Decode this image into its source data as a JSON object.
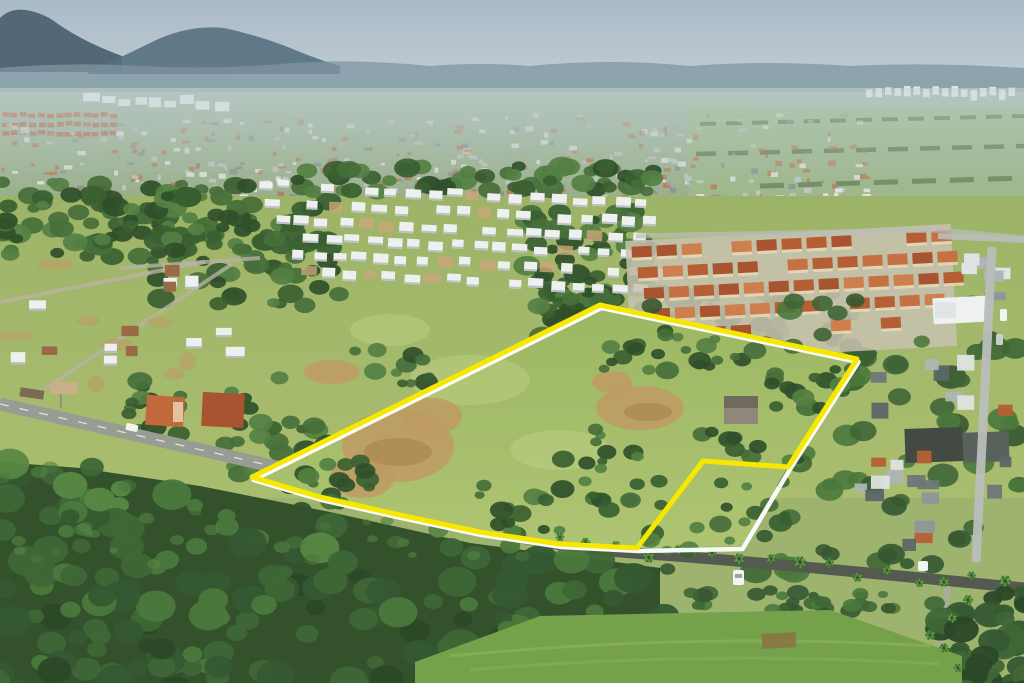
{
  "scene": {
    "description": "Aerial drone photograph of a suburban neighborhood; a vacant grassy land parcel in the foreground is outlined with a bright yellow boundary line, with a small corner sub-lot delimited in white; dense forest in the foreground, housing developments and distant city with hazy mountains behind",
    "seed": 7,
    "features": [
      "sky",
      "mountains",
      "distant-city",
      "housing-development",
      "townhouse-complex",
      "vacant-parcel",
      "boundary-overlay",
      "forest",
      "roads",
      "palm-trees",
      "cars"
    ]
  },
  "overlay": {
    "site_points": "252,477 600,305 857,359 788,467 741,546 637,548 560,544 480,532 400,515 320,497",
    "parcel_points": "252,477 600,305 857,359 788,467 703,461 637,548 560,544 480,532 400,515 320,497",
    "site_color": "#ffffff",
    "parcel_color": "#f7e800",
    "site_width": "4.5",
    "parcel_width": "5"
  },
  "palette": {
    "sky_top": "#a9bac8",
    "sky_bottom": "#c7d0d5",
    "mountain_near": "#4d6371",
    "mountain_mid": "#567080",
    "hills_far": "#7e96a3",
    "hills_faint": "#8ba4a4",
    "valley_top": "#a2b59f",
    "valley_bottom": "#93ab7e",
    "haze": "#c5d4dc",
    "city_white": "#e9ebe8",
    "city_gray": "#c2c7c5",
    "city_terra": "#b96f4a",
    "city_slate": "#98a2a6",
    "city_dark": "#7e8a8e",
    "terra_row": "#b66a45",
    "dev_white": "#edf0ef",
    "dev_shadow": "#b5bcbf",
    "dev_dirt": "#c9a878",
    "grove_greens": [
      "#2f4f2a",
      "#3a5f31",
      "#476f39",
      "#548043"
    ],
    "field_mid": "#a0b76b",
    "field_light": "#aabe70",
    "meadow": "#a4bd68",
    "meadow_light": "#bdd083",
    "dirt": "#c09a64",
    "dirt_dark": "#a9834f",
    "roof_terracotta": [
      "#b65f35",
      "#c57143",
      "#a85430",
      "#cd7f4e"
    ],
    "wall_cream": "#ead9b6",
    "complex_ground": "#c8c2b0",
    "shed_wall": "#8d8879",
    "shed_roof": "#6e6a5e",
    "gray_roofs": [
      "#8e9799",
      "#6d7779",
      "#aeb5b6",
      "#dfe3e3",
      "#5c6668"
    ],
    "warehouse_dark": "#434a42",
    "warehouse_mid": "#59625a",
    "road_light": "#989d94",
    "road_dash": "#e9e9e2",
    "road_dark": "#545a4f",
    "street_concrete": "#b9beba",
    "path_light": "#a9ae9e",
    "forest_greens": [
      "#2b4827",
      "#355831",
      "#3f6636",
      "#4b783c",
      "#588745"
    ],
    "forest_base": "#33522b",
    "palm_leaf": "#5f9e44",
    "palm_dark": "#3c6a2f",
    "grass_field": "#76a14b",
    "grass_stripe": "#8fb75e",
    "car_white": "#f2f4f2",
    "car_silver": "#c9cdcc",
    "truck_brown": "#7c6a55",
    "pasture": "#9ab584",
    "tree_row": "#4c6b3d"
  }
}
